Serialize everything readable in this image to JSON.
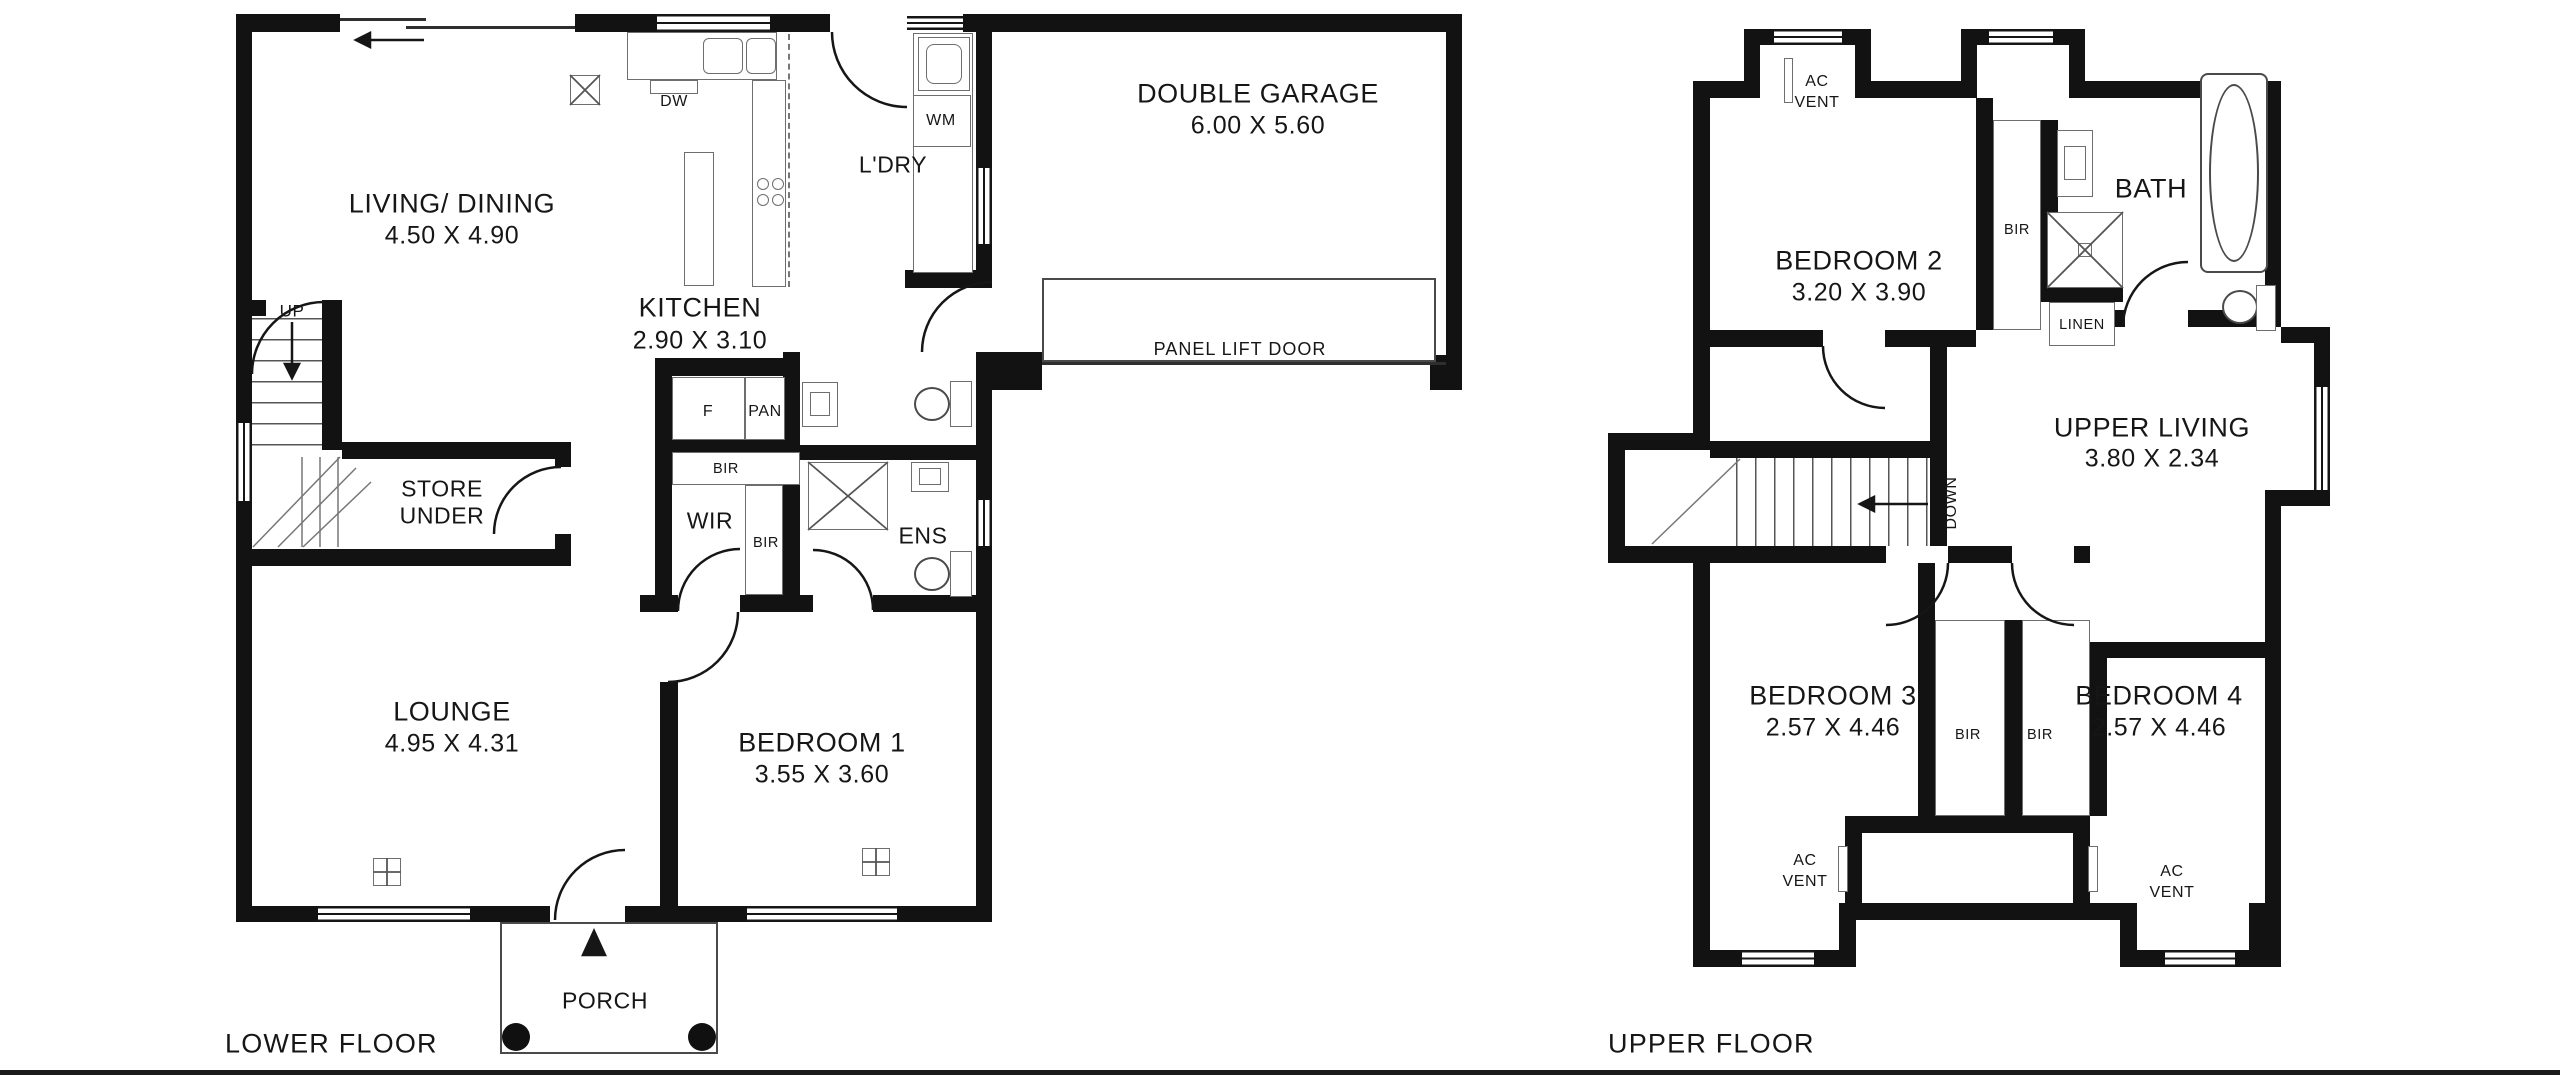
{
  "colors": {
    "wall": "#121212",
    "thin_line": "#4a4a4a",
    "text": "#161616",
    "background": "#ffffff"
  },
  "lower": {
    "title": "LOWER FLOOR",
    "living_name": "LIVING/ DINING",
    "living_dims": "4.50 X 4.90",
    "kitchen_name": "KITCHEN",
    "kitchen_dims": "2.90 X 3.10",
    "garage_name": "DOUBLE GARAGE",
    "garage_dims": "6.00 X 5.60",
    "panel_door": "PANEL LIFT DOOR",
    "laundry": "L'DRY",
    "dw": "DW",
    "wm": "WM",
    "up": "UP",
    "store_line1": "STORE",
    "store_line2": "UNDER",
    "fridge": "F",
    "pantry": "PAN",
    "wir": "WIR",
    "ens": "ENS",
    "lounge_name": "LOUNGE",
    "lounge_dims": "4.95 X 4.31",
    "bed1_name": "BEDROOM 1",
    "bed1_dims": "3.55 X 3.60",
    "porch": "PORCH"
  },
  "upper": {
    "title": "UPPER FLOOR",
    "bed2_name": "BEDROOM 2",
    "bed2_dims": "3.20 X 3.90",
    "bath": "BATH",
    "linen": "LINEN",
    "down": "DOWN",
    "living_name": "UPPER LIVING",
    "living_dims": "3.80 X 2.34",
    "bed3_name": "BEDROOM 3",
    "bed3_dims": "2.57 X 4.46",
    "bed4_name": "BEDROOM 4",
    "bed4_dims": "2.57 X 4.46"
  },
  "shared": {
    "bir": "BIR",
    "ac": "AC",
    "vent": "VENT"
  }
}
